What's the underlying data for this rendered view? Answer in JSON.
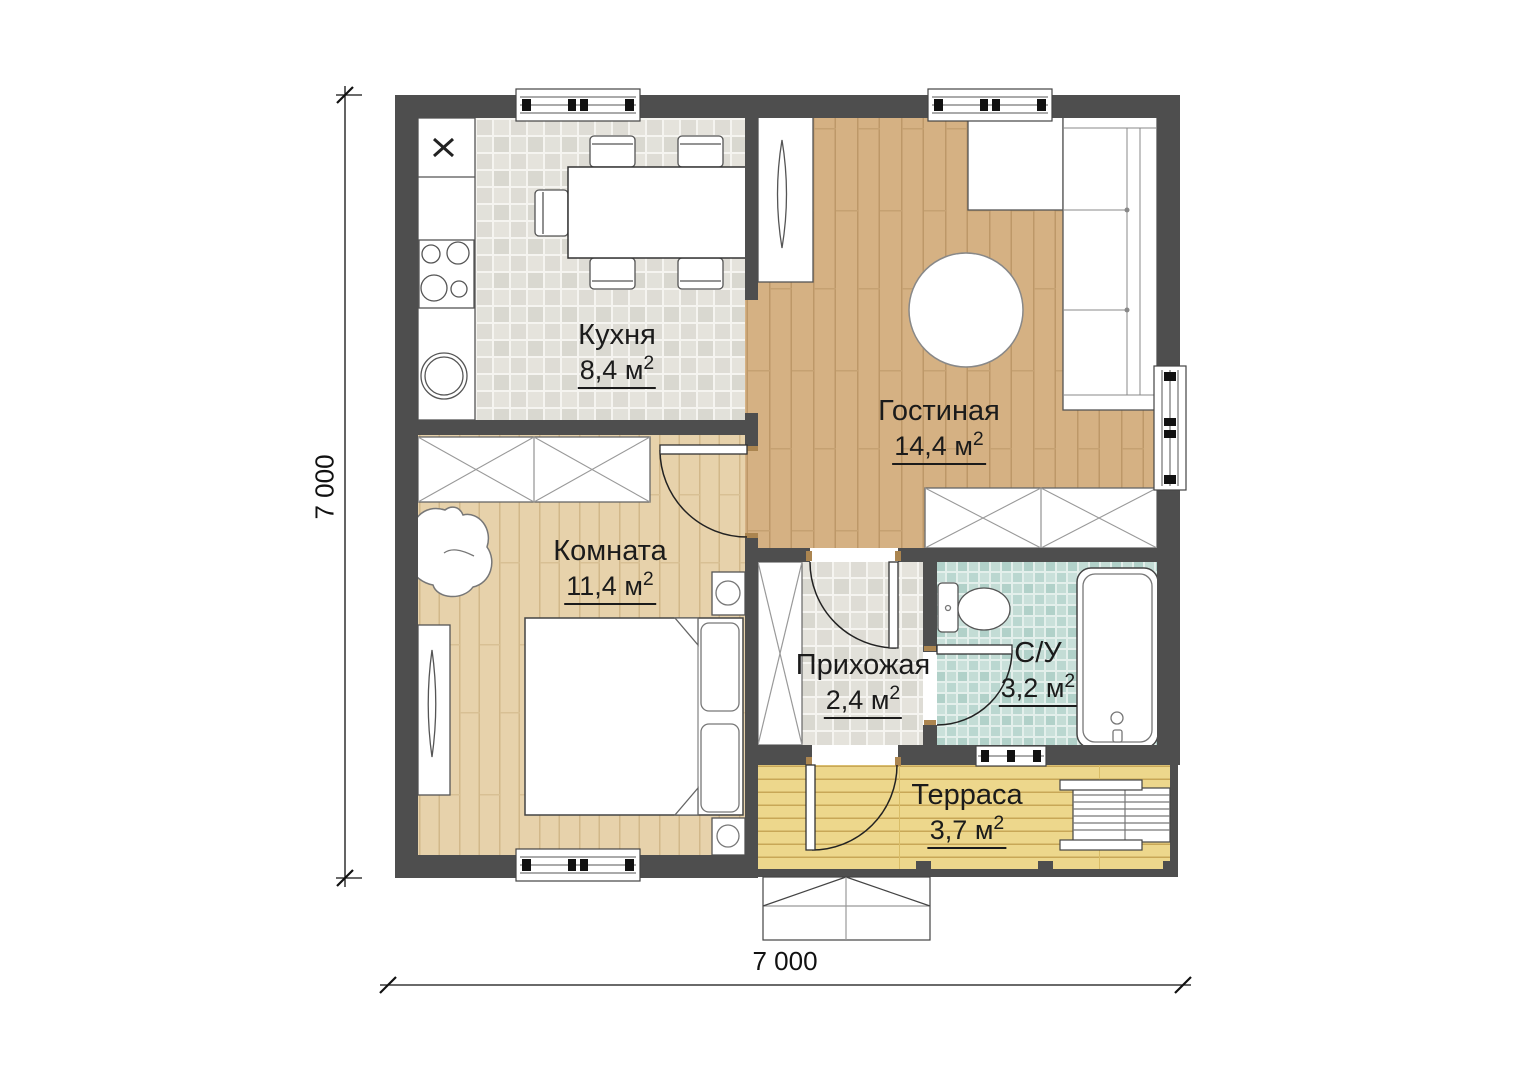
{
  "plan": {
    "title": "floor-plan",
    "rooms": [
      {
        "id": "kitchen",
        "name": "Кухня",
        "area_value": "8,4 м",
        "area_sup": "2"
      },
      {
        "id": "living",
        "name": "Гостиная",
        "area_value": "14,4 м",
        "area_sup": "2"
      },
      {
        "id": "bedroom",
        "name": "Комната",
        "area_value": "11,4 м",
        "area_sup": "2"
      },
      {
        "id": "hallway",
        "name": "Прихожая",
        "area_value": "2,4 м",
        "area_sup": "2"
      },
      {
        "id": "bathroom",
        "name": "С/У",
        "area_value": "3,2 м",
        "area_sup": "2"
      },
      {
        "id": "terrace",
        "name": "Терраса",
        "area_value": "3,7 м",
        "area_sup": "2"
      }
    ],
    "dimensions": {
      "width_label": "7 000",
      "height_label": "7 000"
    },
    "colors": {
      "wall": "#4e4e4e",
      "kitchen_tile": "#e2e1da",
      "hallway_tile": "#e2e1da",
      "bathroom_tile": "#b9d6cf",
      "living_floor": "#d5b183",
      "bedroom_floor": "#e7d2ab",
      "terrace_floor": "#edd78c",
      "furniture_fill": "#ffffff",
      "line": "#333333",
      "door_frame": "#ab8550",
      "text": "#1b1b1b"
    }
  }
}
